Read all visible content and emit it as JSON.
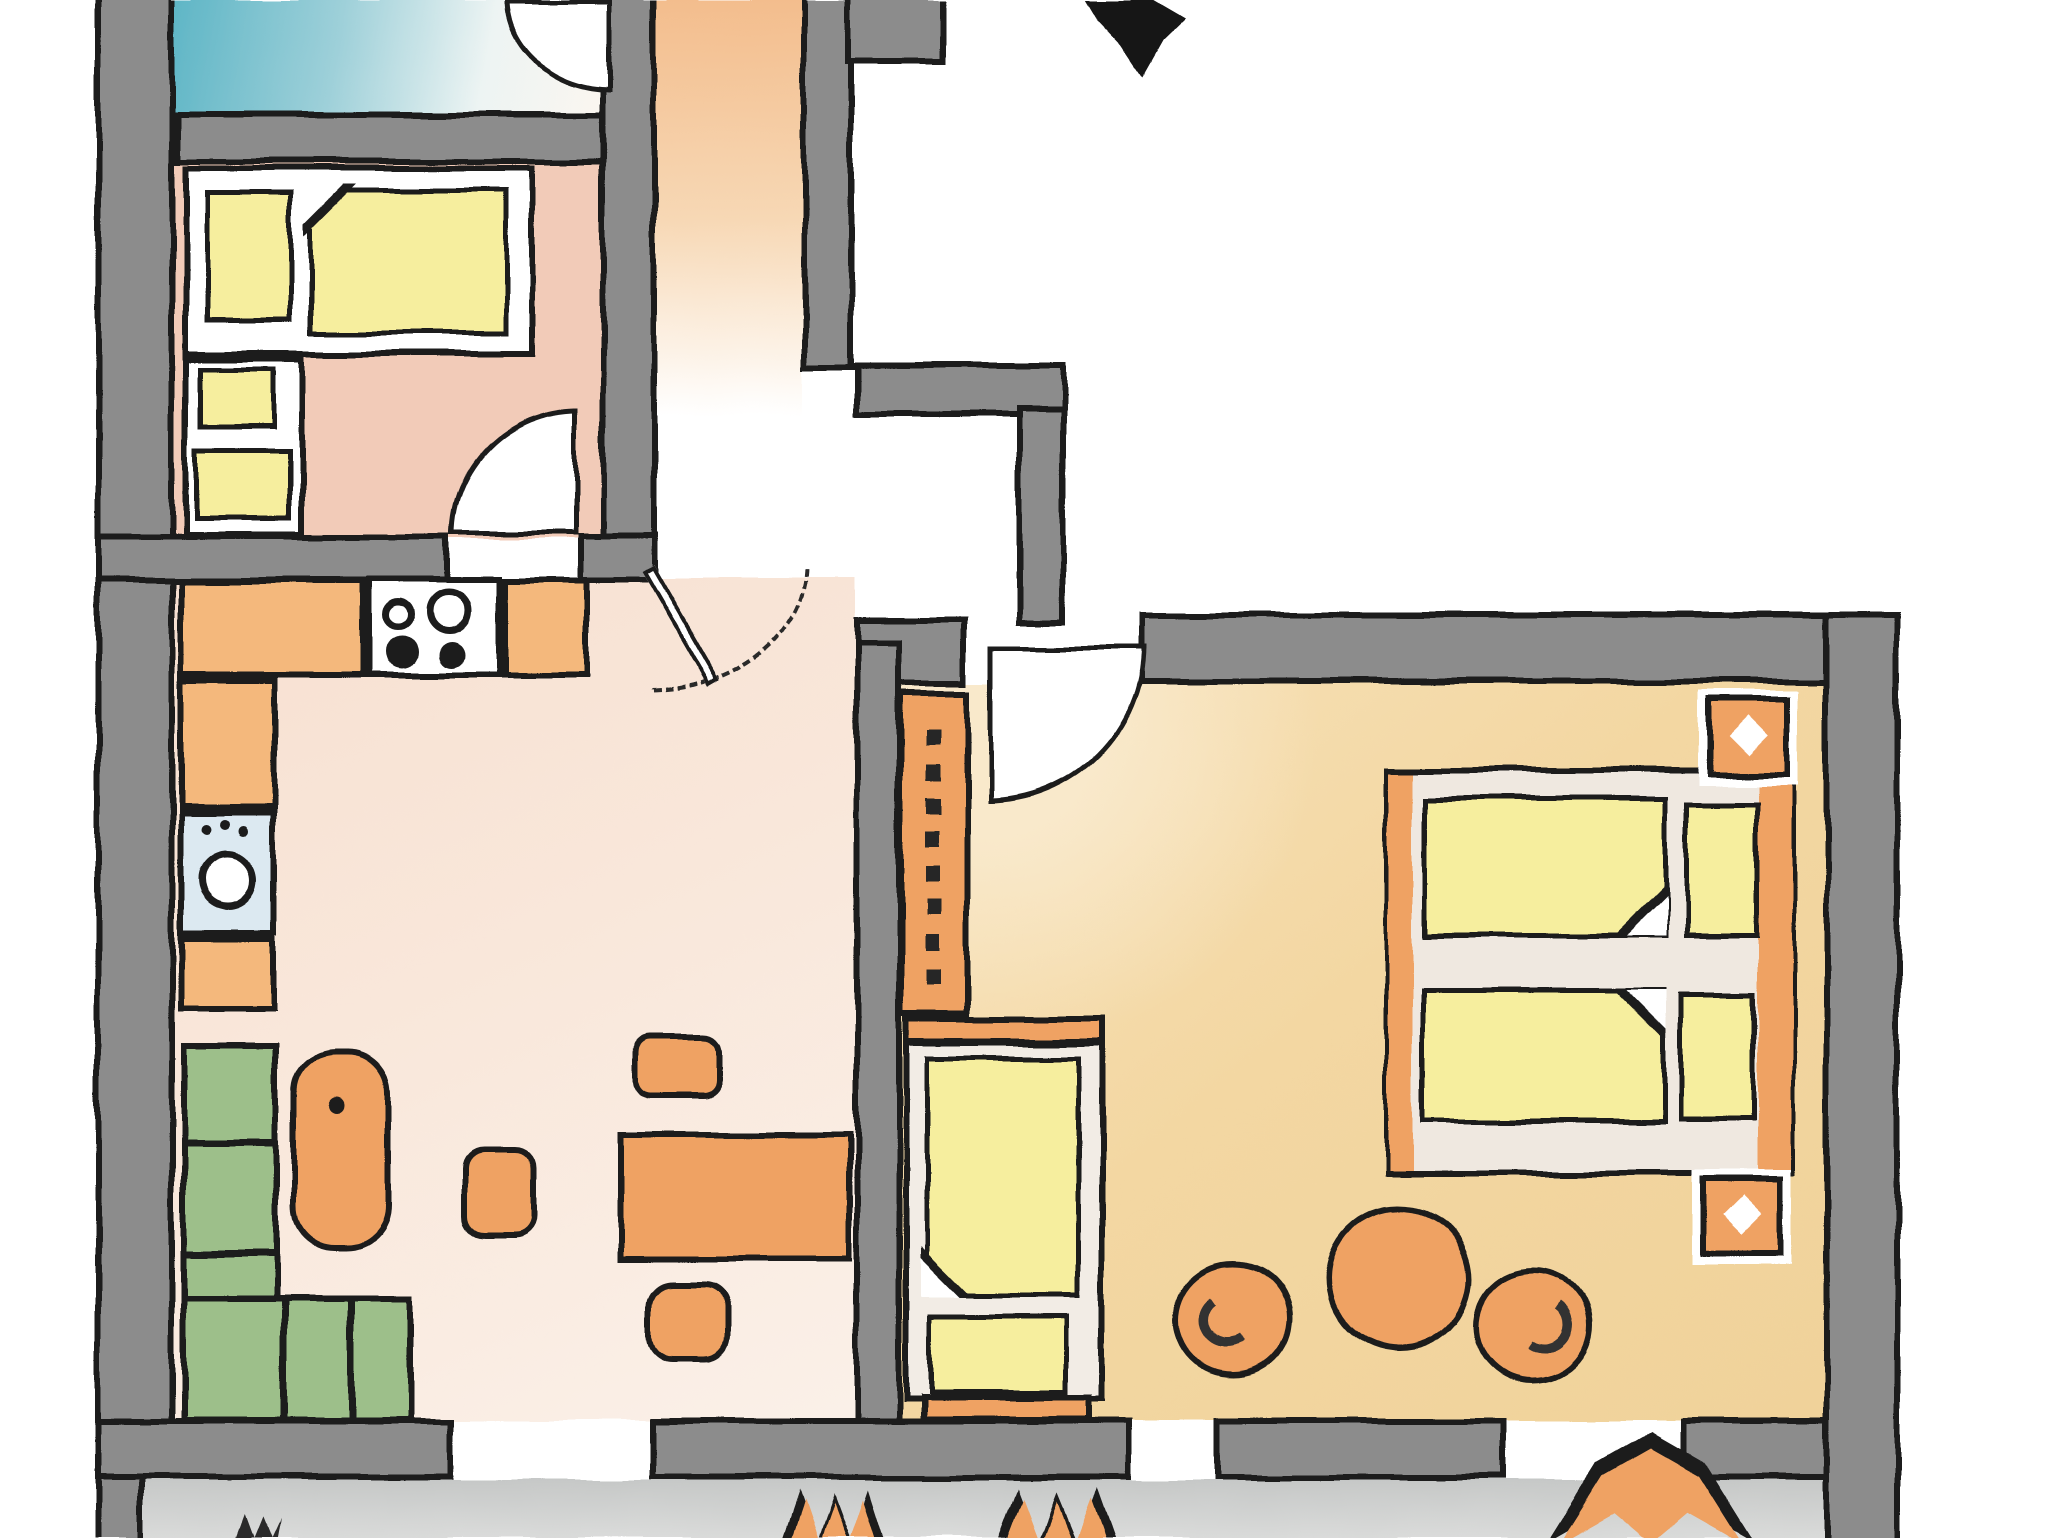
{
  "title": "hand-drawn apartment floor plan (no text labels rendered)",
  "palette": {
    "wall": "#8c8c8c",
    "edge": "#1f1f1f",
    "room-blue": "#5fb6c6",
    "floor-bedroom1": "#f2cbb8",
    "corridor": "#f3bd8d",
    "floor-kitchen": "#f9e7da",
    "floor-bedroom2": "#f3d7a2",
    "floor-balcony": "#cfd1d0",
    "counter": "#f4b87c",
    "furniture": "#efa264",
    "mattress": "#f6ee9e",
    "sofa": "#9dbf8a",
    "washer": "#dce9f1",
    "bed-deck": "#efe8e0"
  },
  "plan": {
    "rooms": [
      {
        "id": "blue-room",
        "floor": "room-blue",
        "furniture": [
          "door-arc"
        ]
      },
      {
        "id": "bedroom-1",
        "floor": "floor-bedroom1",
        "furniture": [
          "bed-with-pillow-and-mattress",
          "side-block",
          "small-bench",
          "door-arc"
        ]
      },
      {
        "id": "stair-corridor",
        "floor": "corridor",
        "furniture": []
      },
      {
        "id": "kitchen-living-room",
        "floor": "floor-kitchen",
        "furniture": [
          "counter-run",
          "stove-4-burners",
          "washing-machine",
          "corner-sofa",
          "sideboard",
          "dining-table",
          "three-chairs",
          "entry-door-leaf-with-dashed-arc"
        ]
      },
      {
        "id": "bedroom-2",
        "floor": "floor-bedroom2",
        "furniture": [
          "wardrobe-with-hooks",
          "single-bed",
          "double-bed-two-mattresses-two-pillows",
          "nightstand-with-lamp-top",
          "nightstand-with-lamp-bottom",
          "round-table",
          "armchair-left",
          "armchair-right",
          "door-arc"
        ]
      },
      {
        "id": "balcony",
        "floor": "floor-balcony",
        "furniture": [
          "plant-zigzag-small-1",
          "plant-zigzag-small-2",
          "plant-chevron-large"
        ]
      }
    ],
    "openings": [
      "balcony-door-living",
      "balcony-window-left",
      "balcony-window-right",
      "bedroom1-door",
      "bedroom2-door",
      "blue-room-door",
      "apartment-entry-door"
    ]
  }
}
